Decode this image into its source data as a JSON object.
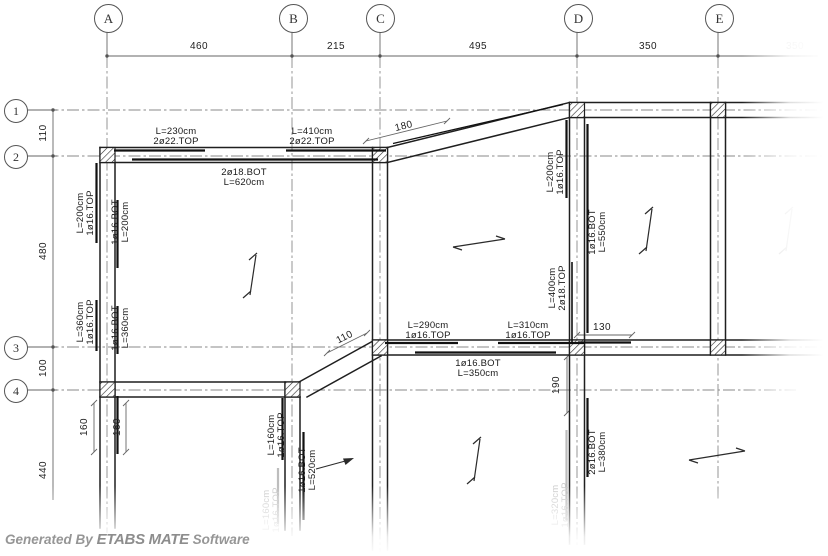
{
  "watermark": {
    "generated_by": "Generated By",
    "brand": "ETABS MATE",
    "software": "Software"
  },
  "grid": {
    "cols": [
      "A",
      "B",
      "C",
      "D",
      "E"
    ],
    "rows": [
      "1",
      "2",
      "3",
      "4"
    ]
  },
  "dims": {
    "top": [
      "460",
      "215",
      "495",
      "350",
      "350"
    ],
    "left": [
      "110",
      "480",
      "100",
      "440"
    ],
    "diag_c2_d1": "180",
    "diag_c3_b4": "110",
    "right_of_d3": "130",
    "below_d3": "190",
    "below_a4_1": "160",
    "below_a4_2": "160"
  },
  "beam_labels": {
    "row2_left_top": "L=230cm\n2ø22.TOP",
    "row2_right_top": "L=410cm\n2ø22.TOP",
    "row2_bottom": "2ø18.BOT\nL=620cm",
    "row3_left_top": "L=290cm\n1ø16.TOP",
    "row3_right_top": "L=310cm\n1ø16.TOP",
    "row3_bottom": "1ø16.BOT\nL=350cm",
    "col_a_upper_left": "L=200cm\n1ø16.TOP",
    "col_a_upper_right": "1ø16.BOT\nL=200cm",
    "col_a_lower_left": "L=360cm\n1ø16.TOP",
    "col_a_lower_right": "1ø16.BOT\nL=360cm",
    "col_d_upper_left": "L=200cm\n1ø16.TOP",
    "col_d_upper_right": "1ø16.BOT\nL=550cm",
    "col_d_mid_left": "L=400cm\n2ø18.TOP",
    "col_d_lower_right": "2ø16.BOT\nL=380cm",
    "col_d_lower_left_faint": "L=320cm\n1ø16.TOP",
    "col_b_upper_left": "L=160cm\n1ø16.TOP",
    "col_b_lower_right": "1ø16.BOT\nL=520cm",
    "col_b_lower_left_faint": "L=160cm\n1ø16.TOP"
  },
  "colors": {
    "line": "#1f1f1f",
    "centerline": "#8a8a8a",
    "dim": "#666666",
    "faint": "#c9c9c9",
    "watermark": "#949494"
  }
}
